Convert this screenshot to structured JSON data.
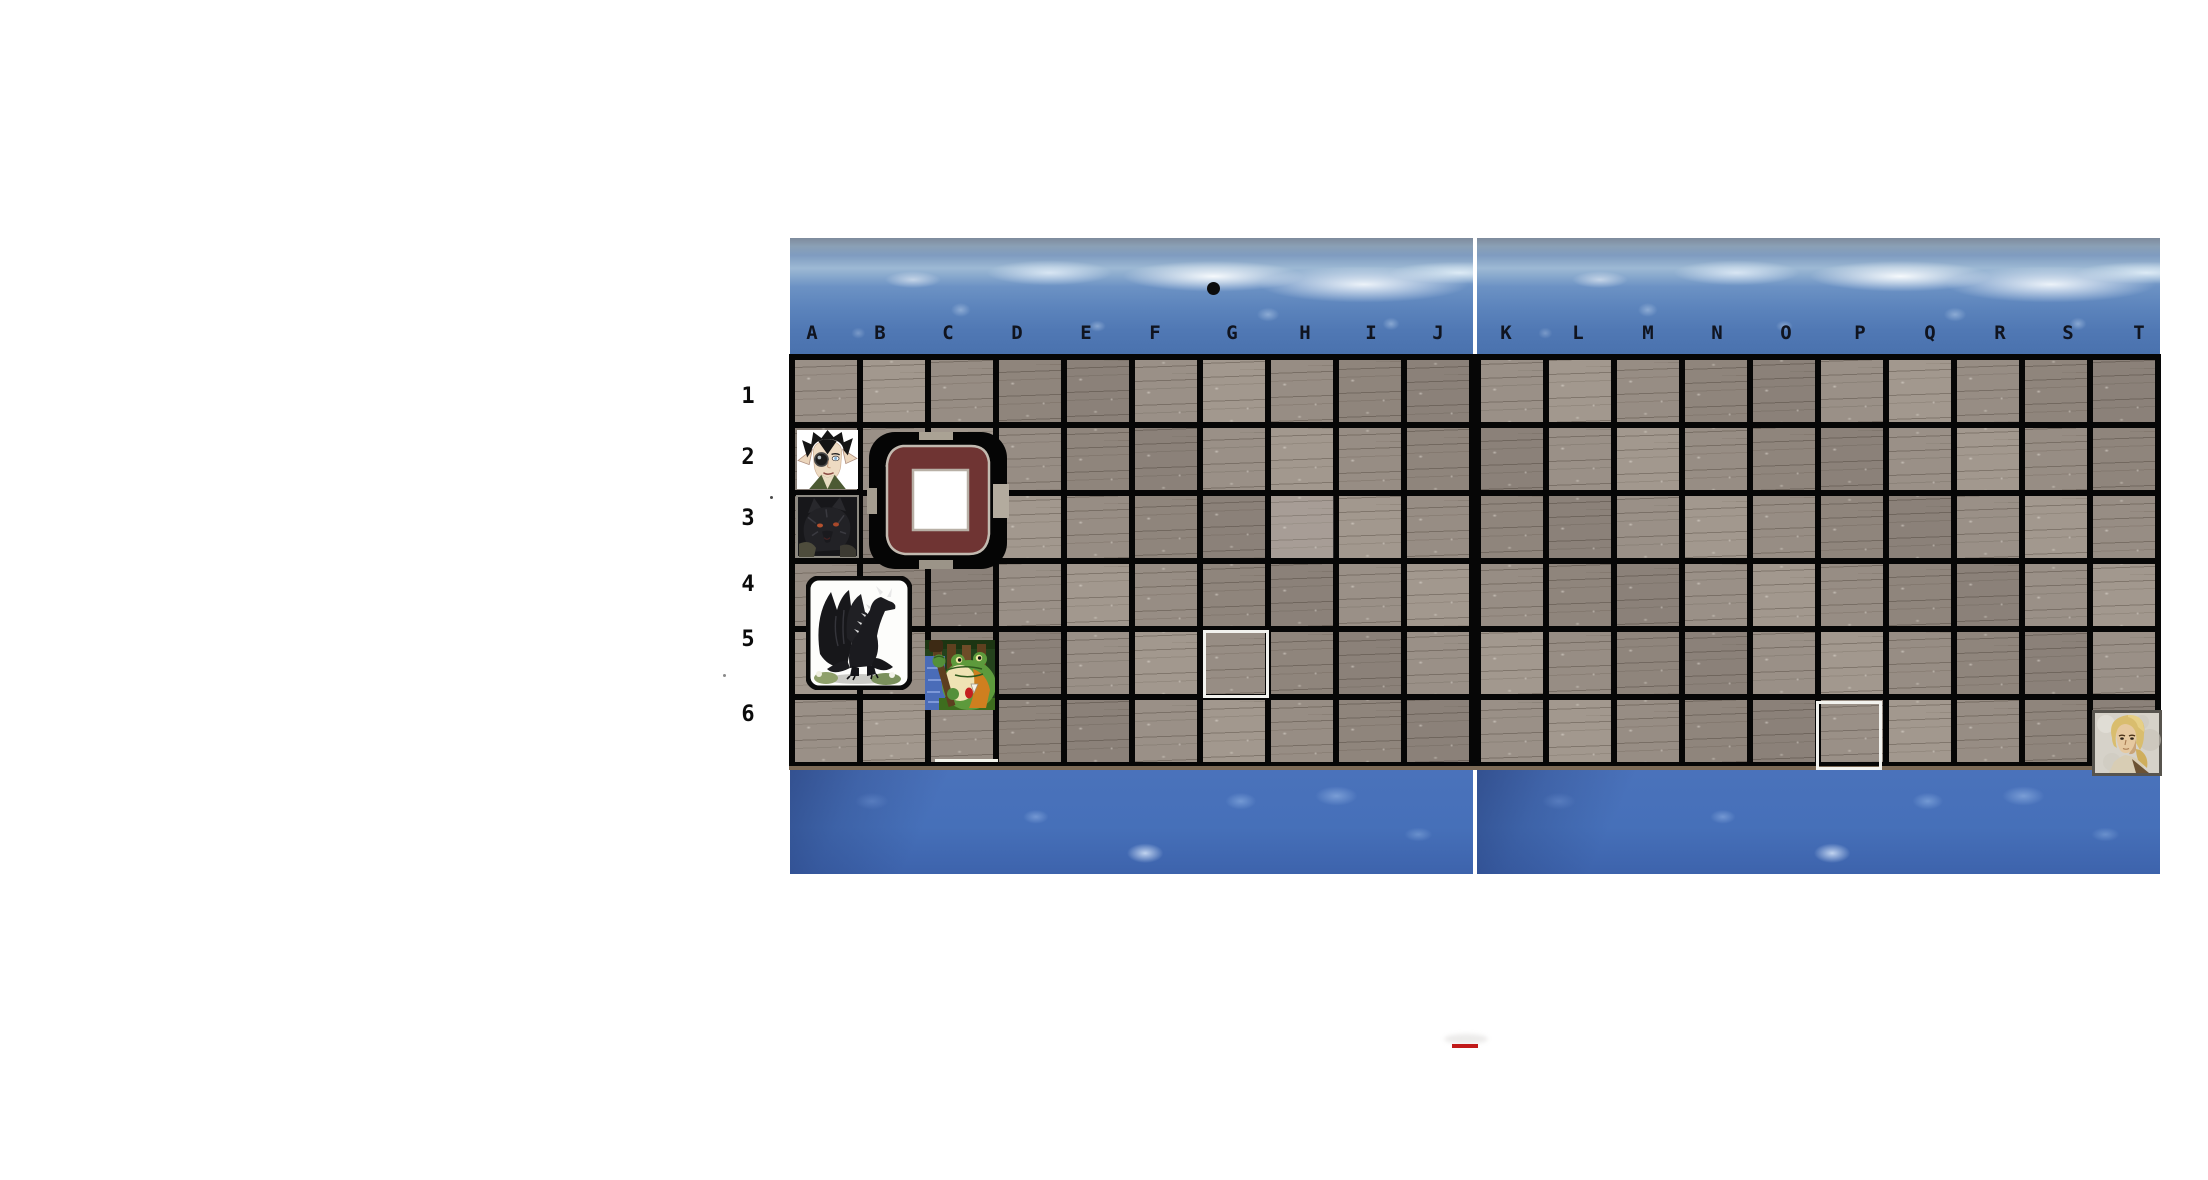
{
  "board": {
    "column_labels": [
      "A",
      "B",
      "C",
      "D",
      "E",
      "F",
      "G",
      "H",
      "I",
      "J",
      "K",
      "L",
      "M",
      "N",
      "O",
      "P",
      "Q",
      "R",
      "S",
      "T"
    ],
    "row_labels": [
      "1",
      "2",
      "3",
      "4",
      "5",
      "6"
    ],
    "columns": 20,
    "rows": 6
  },
  "tokens": [
    {
      "id": "vampire",
      "label": "vampire portrait",
      "cell": "A2",
      "x": 797,
      "y": 430,
      "w": 61,
      "h": 59
    },
    {
      "id": "wolf",
      "label": "black wolf",
      "cell": "A3",
      "x": 796,
      "y": 495,
      "w": 63,
      "h": 63
    },
    {
      "id": "hatch",
      "label": "ship hatch opening",
      "cell": "B2:C3",
      "x": 867,
      "y": 432,
      "w": 142,
      "h": 137
    },
    {
      "id": "dragon",
      "label": "black dragon",
      "cell": "A4:B5",
      "x": 806,
      "y": 576,
      "w": 106,
      "h": 114
    },
    {
      "id": "frog",
      "label": "frog warrior",
      "cell": "C5",
      "x": 925,
      "y": 640,
      "w": 70,
      "h": 70
    },
    {
      "id": "blonde",
      "label": "blonde human portrait",
      "cell": "T6",
      "x": 2092,
      "y": 710,
      "w": 70,
      "h": 66
    }
  ],
  "highlights": [
    {
      "cell": "G5",
      "x": 1203,
      "y": 630,
      "w": 66,
      "h": 68
    },
    {
      "cell": "P6",
      "x": 1816,
      "y": 701,
      "w": 66,
      "h": 69
    }
  ],
  "markers": {
    "ink_dot": {
      "x": 1207,
      "y": 282,
      "w": 13,
      "h": 13,
      "color": "#0c0c0c"
    },
    "red_dash": {
      "x": 1452,
      "y": 1044,
      "w": 26,
      "h": 4,
      "color": "#c11a1a"
    },
    "smudge": {
      "x": 1444,
      "y": 1034,
      "w": 44,
      "h": 10
    },
    "white_tick": {
      "x": 935,
      "y": 759,
      "w": 63,
      "h": 3,
      "color": "#f2f2ea"
    },
    "specks": [
      {
        "x": 770,
        "y": 496,
        "w": 3,
        "h": 3,
        "color": "#4a4a4a"
      },
      {
        "x": 723,
        "y": 674,
        "w": 3,
        "h": 3,
        "color": "#8a8a8a"
      }
    ]
  },
  "colors": {
    "water_blue": "#4a72b8",
    "foam_white": "#eef4fa",
    "wood_gray": "#968c83",
    "grid_black": "#060606",
    "hatch_maroon": "#6f3433",
    "highlight_white": "#f2f2ee"
  }
}
